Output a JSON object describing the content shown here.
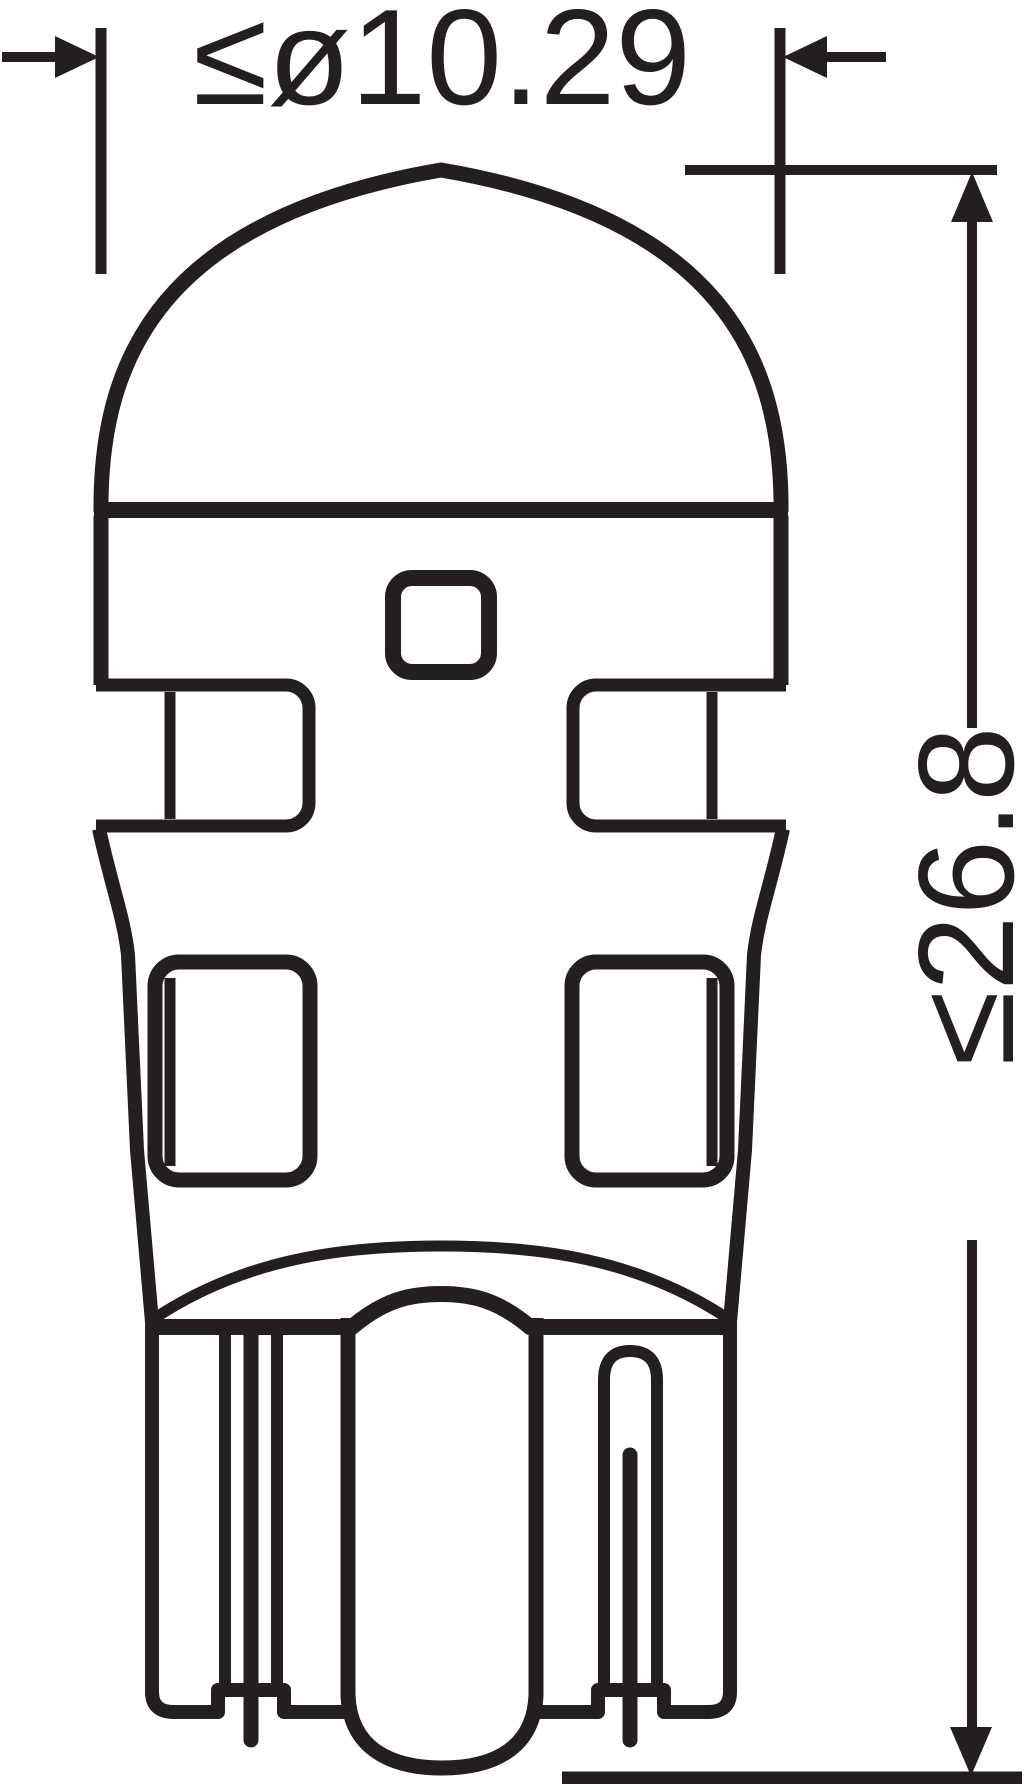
{
  "drawing": {
    "diameter_label": "≤ø10.29",
    "height_label": "≤26.8",
    "ink_color": "#231f20",
    "background_color": "#ffffff"
  }
}
